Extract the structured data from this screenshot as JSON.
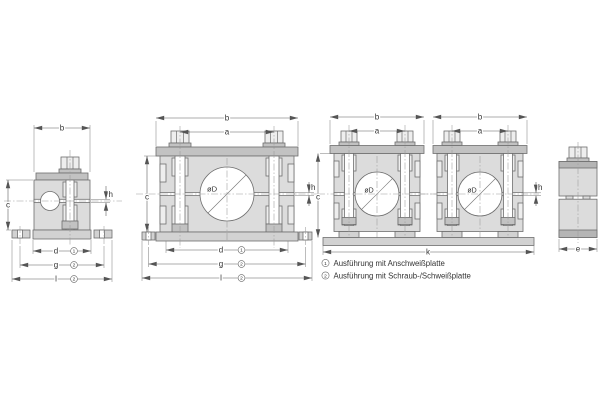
{
  "drawing": {
    "dims": {
      "b": "b",
      "a": "a",
      "c": "c",
      "d": "d",
      "g": "g",
      "l": "l",
      "h": "h",
      "k": "k",
      "e": "e"
    },
    "diameter": "øD",
    "refs": {
      "weld": "1",
      "screw": "2"
    },
    "legend": {
      "items": [
        {
          "ref": "1",
          "text": "Ausführung mit Anschweißplatte"
        },
        {
          "ref": "2",
          "text": "Ausführung mit Schraub-/Schweißplatte"
        }
      ]
    }
  }
}
